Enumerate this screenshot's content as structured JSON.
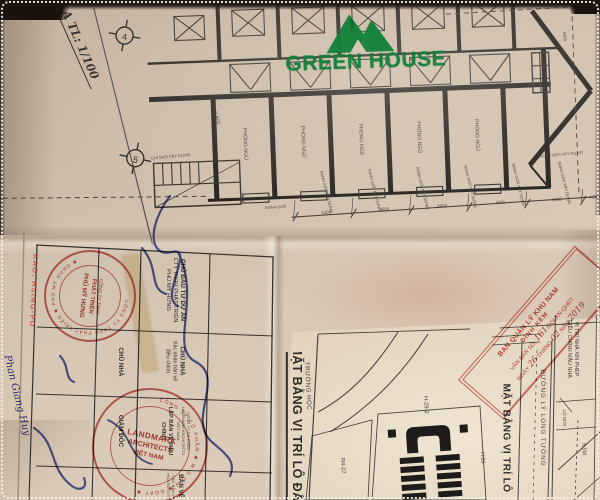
{
  "photo": {
    "border": "dotted-white",
    "paper_color": "#cdbba8",
    "ink_color": "#2b2a28",
    "stamp_red": "#bb4038",
    "signature_blue": "#2c3e96",
    "brand_green": "#128139"
  },
  "watermark": {
    "brand": "GREEN HOUSE",
    "icon": "mountain-peaks-logo"
  },
  "top_sheet": {
    "section_label": "A  TL: 1/100",
    "grid_bubbles": [
      "4",
      "5"
    ],
    "elevation_mark": "-2.800",
    "rooms": [
      "PHÒNG NGỦ",
      "PHÒNG NGỦ",
      "PHÒNG NGỦ",
      "PHÒNG NGỦ",
      "PHÒNG NGỦ"
    ],
    "boundary_labels": {
      "ranh_gioi_xay_dung": "RANH GIỚI XÂY DỰNG",
      "chi_gioi_xay_dung": "CHỈ GIỚI XÂY DỰNG",
      "ranh_gioi": "RANH GIỚI"
    },
    "dimensions": [
      "4100",
      "4000",
      "4000",
      "4000",
      "4000",
      "4950"
    ],
    "dimension_right": "5000"
  },
  "title_block": {
    "investor_header": "CHỦ ĐẦU TƯ DỰ ÁN",
    "investor_line1": "CTY TNHH PHÁT TRIỂN",
    "investor_line2": "PHÚ MỸ HƯNG",
    "owner_header": "CHỦ NHÀ",
    "owner_line1": "Xác nhận bản vẽ",
    "owner_line2": "điều chỉnh",
    "owner_label": "CHỦ NHÀ",
    "director_label": "GIÁM ĐỐC",
    "drafter_header": "LẬP BẢN VẼ ĐIỀU CHỈNH",
    "drafter_line1": "CÔNG TY CỔ PHẦN",
    "drafter_line2": "LANDMARK ARCHITECTS",
    "drafter_line3": "VIỆT NAM",
    "drawing_header": "BẢN VẼ",
    "drawing_line1": "- CÁC BẢN VẼ",
    "drawing_line2": "- HỌA ĐỒ VỊ TRÍ"
  },
  "stamps": {
    "pmh": {
      "ring": "CÔNG TY TNHH PHÁT TRIỂN ✱ PHÚ MỸ HƯNG ✱",
      "line1": "CÔNG TY TNHH",
      "line2": "PHÁT TRIỂN",
      "line3": "PHÚ MỸ HƯNG"
    },
    "landmark": {
      "ring": "CÔNG TY CỔ PHẦN ✱ M.S.D.N ✱ GÓAY ✱",
      "line1": "LANDMARK",
      "line2": "ARCHITECTS",
      "line3": "VIỆT NAM"
    },
    "bqlkn": {
      "line1": "BAN QUẢN LÝ KHU NAM",
      "line2": "ĐÍNH KÈM",
      "line3_prefix": "VĂN BẢN SỐ:",
      "line3_hand": "161",
      "line3_suffix": "/BQLKN-QHĐT",
      "line4_prefix": "NGÀY",
      "line4_hand1": "26",
      "line4_mid1": "THÁNG",
      "line4_hand2": "02",
      "line4_mid2": "NĂM",
      "line4_hand3": "2019"
    }
  },
  "handwriting": {
    "reviewer_stamp_name": "KAO, HSING-PO",
    "owner_signature_name": "Phan Giang Huy"
  },
  "bottom_sheet": {
    "main_title": "MẶT BẰNG VỊ TRÍ LÔ ĐẤT",
    "plan_title": "MẶT BẰNG VỊ TRÍ LÔ",
    "street_name": "ĐƯỜNG LÝ LONG TƯỜNG",
    "school_label": "TRƯỜNG HỌC",
    "lot_r4": "R4-27",
    "lot_h29": "H-29-2",
    "lot_h26": "H-26",
    "location_note_line1": "VỊ TRÍ NHÀ XIN PHÉP",
    "location_note_line2": "ĐIỀU CHỈNH MẪU NHÀ",
    "lo_gioi_label": "LỘ GIỚI",
    "road_width": "6,5M"
  }
}
